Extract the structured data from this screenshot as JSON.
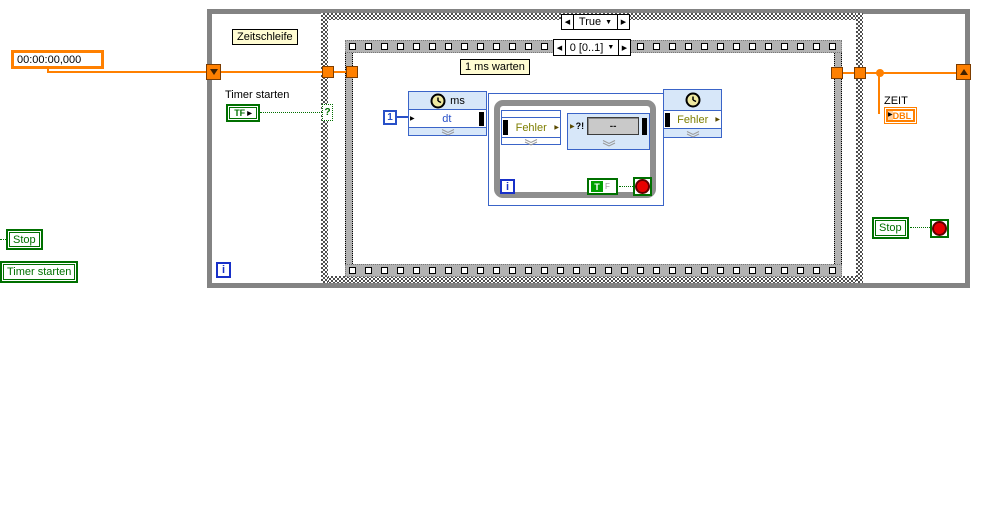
{
  "labels": {
    "zeitschleife": "Zeitschleife",
    "ms_warten": "1 ms warten",
    "timer_starten_top": "Timer starten",
    "zeit": "ZEIT"
  },
  "case_structure": {
    "selector_value": "True"
  },
  "sequence": {
    "selector_value": "0 [0..1]"
  },
  "controls": {
    "time_display": "00:00:00,000",
    "tf_label": "TF",
    "stop_left": "Stop",
    "timer_starten_left": "Timer starten",
    "stop_right": "Stop",
    "zeit_type": "DBL",
    "case_terminal": "?"
  },
  "nodes": {
    "wait_ms": {
      "unit": "ms",
      "input": "dt"
    },
    "error1": {
      "label": "Fehler"
    },
    "display": {
      "prefix": "?!",
      "value": "--"
    },
    "error2": {
      "label": "Fehler"
    },
    "const_one": "1",
    "true_const": {
      "t": "T",
      "f": "F"
    },
    "iterator": "i"
  },
  "icons": {
    "left_arrow": "◀",
    "right_arrow": "▶",
    "dropdown": "▼",
    "in_arrow": "▶"
  },
  "colors": {
    "wire_orange": "#ff8000",
    "bool_green": "#007000",
    "int_blue": "#2850c8",
    "express_bg": "#d7e7f9",
    "error_olive": "#7e7e00"
  }
}
